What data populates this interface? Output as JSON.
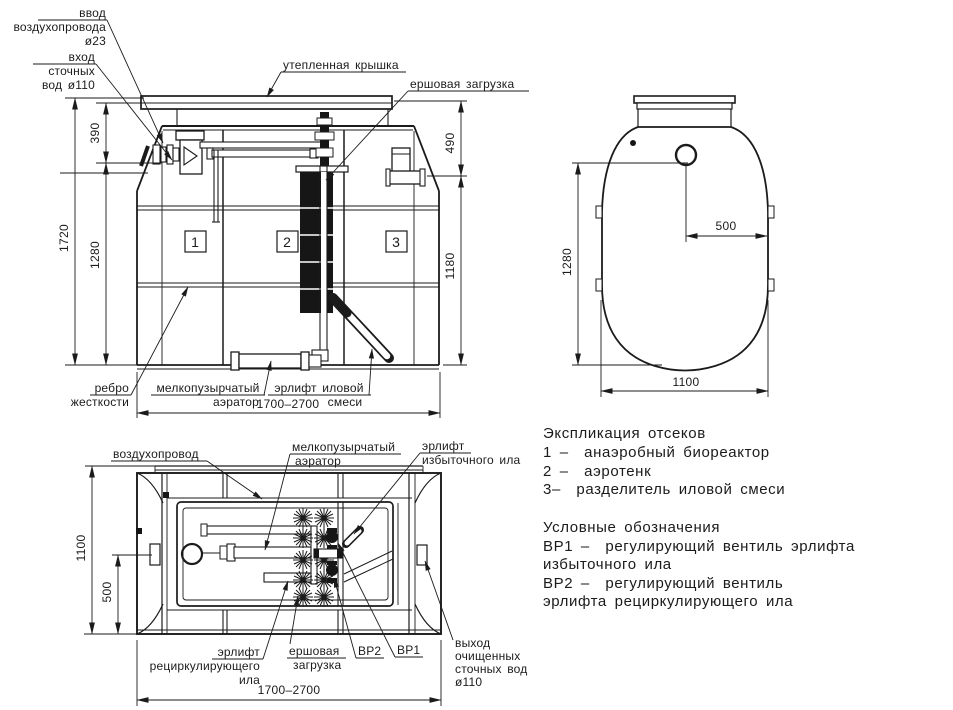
{
  "fv": {
    "c1": "1",
    "c2": "2",
    "c3": "3",
    "air1": "ввод",
    "air2": "воздухопровода",
    "air3": "ø23",
    "in1": "вход",
    "in2": "сточных",
    "in3": "вод ø110",
    "cover": "утепленная крышка",
    "brush": "ершовая загрузка",
    "rib1": "ребро",
    "rib2": "жесткости",
    "aer1": "мелкопузырчатый",
    "aer2": "аэратор",
    "lift1": "эрлифт иловой",
    "lift2": "смеси",
    "d_total_h": "1720",
    "d_top": "390",
    "d_body": "1280",
    "d_cover": "490",
    "d_depth": "1180",
    "d_len": "1700–2700"
  },
  "sv": {
    "d_h": "1280",
    "d_half": "500",
    "d_w": "1100"
  },
  "pv": {
    "duct": "воздухопровод",
    "aer1": "мелкопузырчатый",
    "aer2": "аэратор",
    "ex1": "эрлифт",
    "ex2": "избыточного ила",
    "re1": "эрлифт",
    "re2": "рециркулирующего",
    "re3": "ила",
    "br1": "ершовая",
    "br2": "загрузка",
    "bp2": "ВР2",
    "bp1": "ВР1",
    "out1": "выход",
    "out2": "очищенных",
    "out3": "сточных вод",
    "out4": "ø110",
    "d_w": "1100",
    "d_off": "500",
    "d_len": "1700–2700"
  },
  "legend": {
    "title": "Экспликация отсеков",
    "i1": "1 –  анаэробный биореактор",
    "i2": "2 –  аэротенк",
    "i3": "3–  разделитель иловой смеси",
    "sub": "Условные обозначения",
    "s1": "ВР1 –  регулирующий вентиль эрлифта",
    "s2": "избыточного ила",
    "s3": "ВР2 –  регулирующий вентиль",
    "s4": "эрлифта рециркулирующего ила"
  }
}
